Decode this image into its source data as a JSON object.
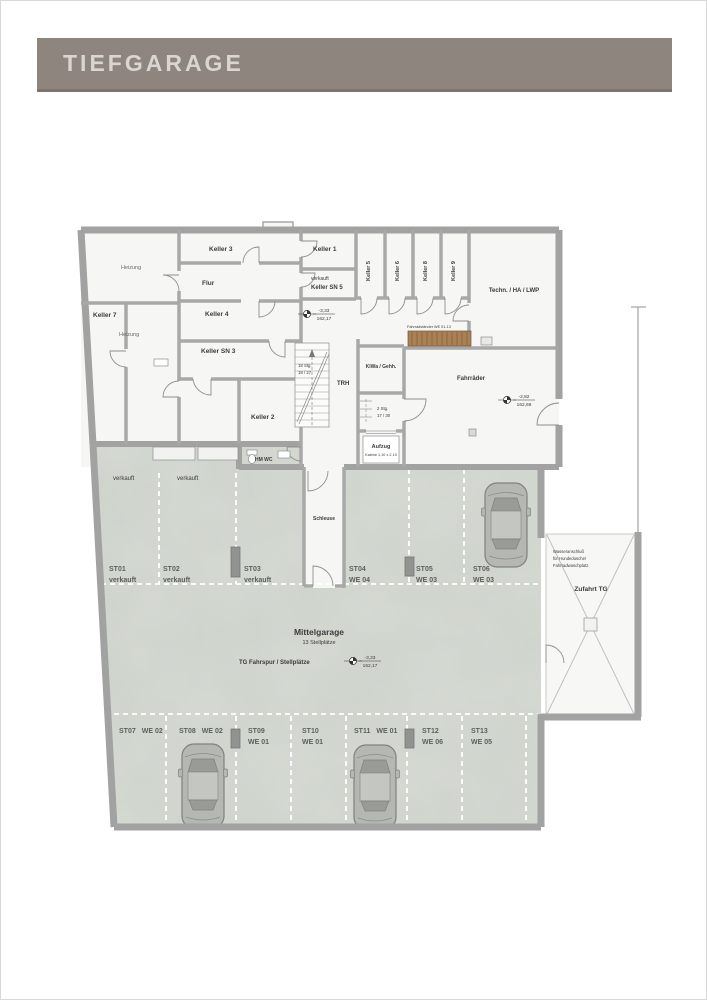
{
  "header": {
    "title": "TIEFGARAGE"
  },
  "plan": {
    "rooms": {
      "heizung_top": "Heizung",
      "heizung_left": "Heizung",
      "keller7": "Keller 7",
      "flur": "Flur",
      "keller3": "Keller 3",
      "keller4": "Keller 4",
      "keller_sn3": "Keller SN 3",
      "keller1": "Keller 1",
      "verkauft_note": "verkauft",
      "keller_sn5": "Keller SN 5",
      "keller5": "Keller 5",
      "keller6": "Keller 6",
      "keller8": "Keller 8",
      "keller9": "Keller 9",
      "technik": "Techn. / HA / LWP",
      "keller2": "Keller 2",
      "hm_wc": "HM WC",
      "trh": "TRH",
      "kiwa": "KiWa / Gehh.",
      "aufzug": "Aufzug",
      "aufzug_sub": "Kabine 1,10 x 2,10",
      "fahrraeder": "Fahrräder",
      "fahrradstaender": "Fahrradständer WE 01-13",
      "schleuse": "Schleuse"
    },
    "stairs": {
      "main_steps": "18 Stg.",
      "main_ratio": "18 / 27",
      "small_steps": "2 Stg.",
      "small_ratio": "17 / 30"
    },
    "levels": {
      "hall": {
        "value": "-3,33",
        "elevation": "162,17"
      },
      "bikes": {
        "value": "-2,82",
        "elevation": "162,69"
      },
      "garage": {
        "value": "-3,33",
        "elevation": "162,17"
      }
    },
    "garage": {
      "title": "Mittelgarage",
      "subtitle": "13 Stellplätze",
      "lane": "TG Fahrspur / Stellplätze",
      "ramp": "Zufahrt TG",
      "note_line1": "Wasseranschluß",
      "note_line2": "für Hundedusche/",
      "note_line3": "Fahrradwaschplatz",
      "sold_left": "verkauft",
      "sold_right": "verkauft"
    },
    "stalls": [
      {
        "id": "ST01",
        "sub": "verkauft"
      },
      {
        "id": "ST02",
        "sub": "verkauft"
      },
      {
        "id": "ST03",
        "sub": "verkauft"
      },
      {
        "id": "ST04",
        "sub": "WE 04"
      },
      {
        "id": "ST05",
        "sub": "WE 03"
      },
      {
        "id": "ST06",
        "sub": "WE 03"
      },
      {
        "id": "ST07",
        "sub": "WE 02"
      },
      {
        "id": "ST08",
        "sub": "WE 02"
      },
      {
        "id": "ST09",
        "sub": "WE 01"
      },
      {
        "id": "ST10",
        "sub": "WE 01"
      },
      {
        "id": "ST11",
        "sub": "WE 01"
      },
      {
        "id": "ST12",
        "sub": "WE 06"
      },
      {
        "id": "ST13",
        "sub": "WE 05"
      }
    ]
  }
}
